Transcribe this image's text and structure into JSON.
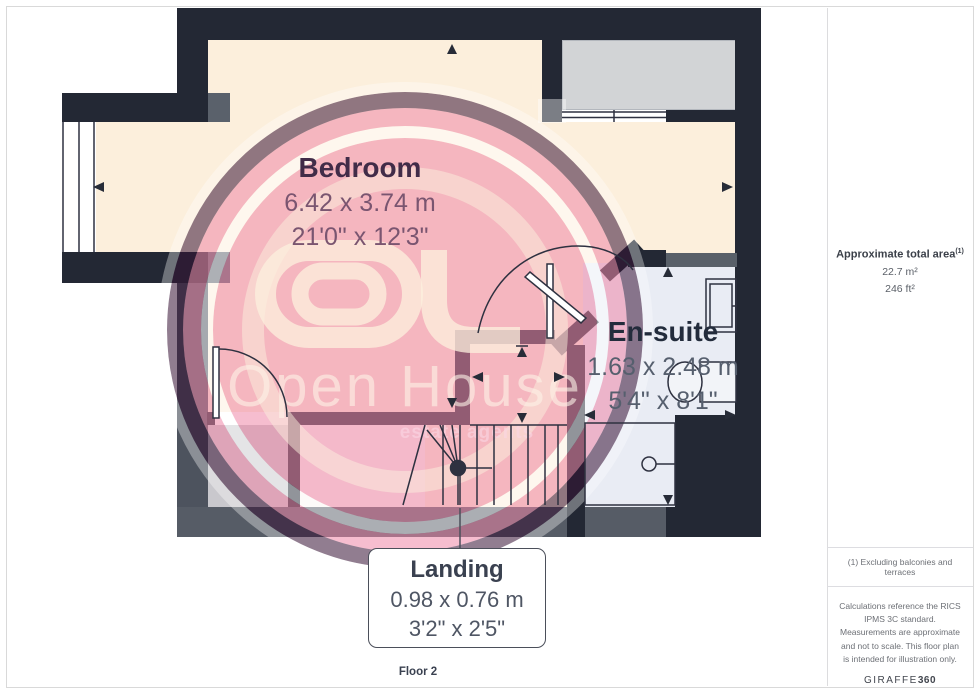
{
  "floor_label": "Floor 2",
  "rooms": {
    "bedroom": {
      "name": "Bedroom",
      "dim_metric": "6.42 x 3.74 m",
      "dim_imperial": "21'0\" x 12'3\""
    },
    "ensuite": {
      "name": "En-suite",
      "dim_metric": "1.63 x 2.48 m",
      "dim_imperial": "5'4\" x 8'1\""
    },
    "landing": {
      "name": "Landing",
      "dim_metric": "0.98 x 0.76 m",
      "dim_imperial": "3'2\" x 2'5\""
    }
  },
  "sidebar": {
    "area_title": "Approximate total area",
    "area_footnote_marker": "(1)",
    "area_metric": "22.7 m²",
    "area_imperial": "246 ft²",
    "note_footnote": "(1) Excluding balconies and terraces",
    "note_disclaimer": "Calculations reference the RICS IPMS 3C standard. Measurements are approximate and not to scale. This floor plan is intended for illustration only.",
    "brand": "GIRAFFE",
    "brand_suffix": "360"
  },
  "watermark": {
    "line1": "Open House",
    "line2": "estate agents"
  },
  "colors": {
    "wall_dark": "#232834",
    "wall_slate": "#565c66",
    "floor_bedroom": "#fcefdc",
    "floor_ensuite": "#e9ecf4",
    "floor_storage": "#c9c8cd",
    "watermark_pink": "#ee87a7",
    "watermark_dark_ring": "#371234",
    "line_ink": "#2e3140",
    "label_bedroom": "#412c48",
    "label_ensuite": "#232c3c",
    "label_landing": "#3a4150"
  }
}
